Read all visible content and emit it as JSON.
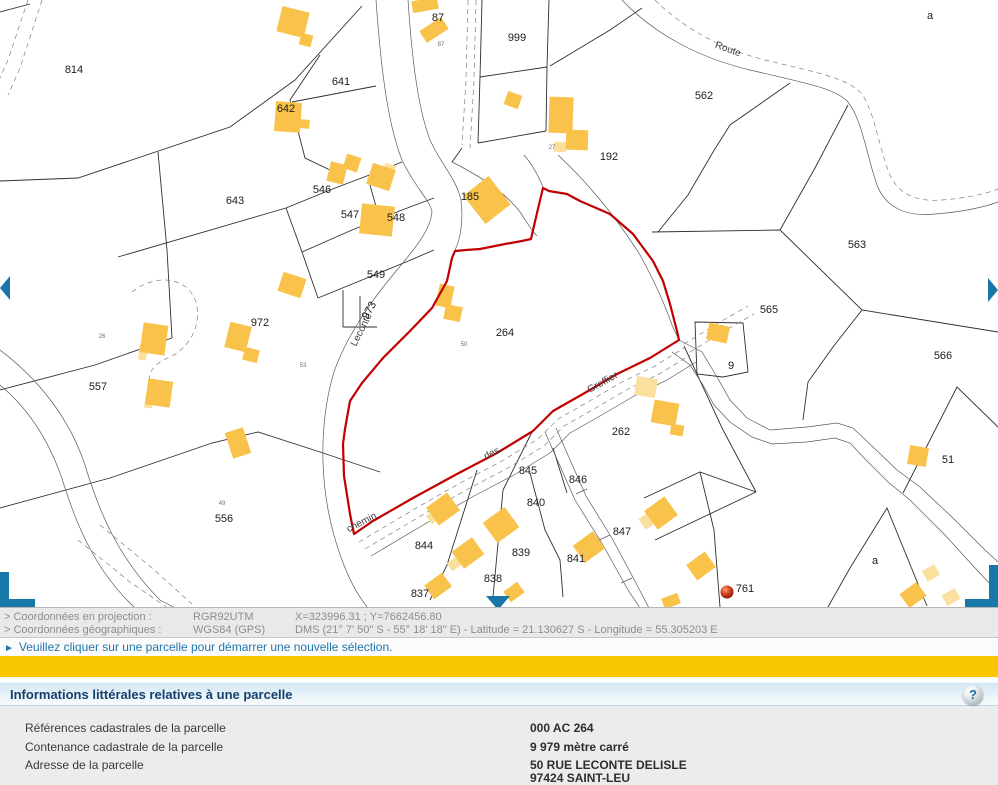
{
  "map": {
    "parcels": [
      {
        "id": "814"
      },
      {
        "id": "87"
      },
      {
        "id": "999"
      },
      {
        "id": "562"
      },
      {
        "id": "641"
      },
      {
        "id": "642"
      },
      {
        "id": "643"
      },
      {
        "id": "546"
      },
      {
        "id": "547"
      },
      {
        "id": "548"
      },
      {
        "id": "549"
      },
      {
        "id": "185"
      },
      {
        "id": "192"
      },
      {
        "id": "563"
      },
      {
        "id": "565"
      },
      {
        "id": "566"
      },
      {
        "id": "972"
      },
      {
        "id": "973"
      },
      {
        "id": "264"
      },
      {
        "id": "9"
      },
      {
        "id": "557"
      },
      {
        "id": "556"
      },
      {
        "id": "262"
      },
      {
        "id": "51"
      },
      {
        "id": "845"
      },
      {
        "id": "846"
      },
      {
        "id": "840"
      },
      {
        "id": "844"
      },
      {
        "id": "839"
      },
      {
        "id": "847"
      },
      {
        "id": "841"
      },
      {
        "id": "838"
      },
      {
        "id": "837"
      },
      {
        "id": "761"
      },
      {
        "id": "a"
      },
      {
        "id": "a"
      }
    ],
    "street_names": [
      {
        "name": "Route"
      },
      {
        "name": "Leconte"
      },
      {
        "name": "chemin"
      },
      {
        "name": "des"
      },
      {
        "name": "Greffier"
      }
    ],
    "house_numbers": [
      {
        "n": "50"
      },
      {
        "n": "26"
      },
      {
        "n": "53"
      },
      {
        "n": "49"
      },
      {
        "n": "87"
      },
      {
        "n": "27"
      }
    ],
    "selected_parcel_color": "#c00000",
    "building_color": "#f9c24a",
    "building_light_color": "#fadf9e",
    "nav_color": "#1878a8"
  },
  "status_bar": {
    "row1": {
      "label": "> Coordonnées en projection :",
      "system": "RGR92UTM",
      "value": "X=323996.31 ; Y=7662456.80"
    },
    "row2": {
      "label": "> Coordonnées géographiques :",
      "system": "WGS84 (GPS)",
      "value": "DMS (21° 7' 50\" S - 55° 18' 18\" E) - Latitude = 21.130627 S - Longitude = 55.305203 E"
    }
  },
  "message_bar": {
    "bullet": "►",
    "text": "Veuillez cliquer sur une parcelle pour démarrer une nouvelle sélection."
  },
  "section_header": {
    "title": "Informations littérales relatives à une parcelle",
    "help_icon": "?"
  },
  "parcel_info": {
    "rows": [
      {
        "label": "Références cadastrales de la parcelle",
        "value": "000 AC 264"
      },
      {
        "label": "Contenance cadastrale de la parcelle",
        "value": "9 979 mètre carré"
      },
      {
        "label": "Adresse de la parcelle",
        "value": "50 RUE LECONTE DELISLE",
        "value2": "97424 SAINT-LEU"
      }
    ]
  }
}
